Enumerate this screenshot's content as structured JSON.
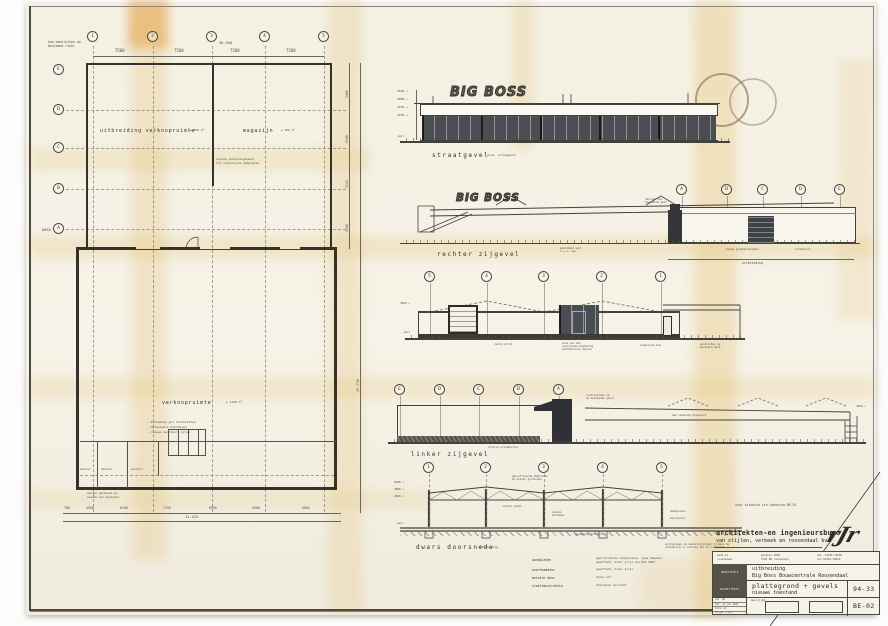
{
  "plan": {
    "cols": [
      "1",
      "2",
      "3",
      "4",
      "5"
    ],
    "rows_letters": [
      "E",
      "D",
      "C",
      "B",
      "A"
    ],
    "dims_top": [
      "7500",
      "7500",
      "7500",
      "7500"
    ],
    "dims_top_total": "30.500",
    "dims_right": [
      "5400",
      "5300",
      "5225",
      "5100"
    ],
    "dims_right_total": "32.720",
    "dim_left": "6850",
    "dims_bottom": [
      "700",
      "4500",
      "6440",
      "7150",
      "6990",
      "5600",
      "6005"
    ],
    "dims_bottom_total": "31.425",
    "label_uitbreiding": "uitbreiding  verkoopruimte",
    "area_uitbreiding": "± 850 m²",
    "label_magazijn": "magazijn",
    "area_magazijn": "± 250 m²",
    "label_verkoop": "verkoopruimte",
    "area_verkoop": "± 1150 m²",
    "note_hwa": [
      "hwa aansluiten op",
      "bestaand riool"
    ],
    "note_wand": [
      "nieuwe scheidingswand",
      "tot onderzijde dakplaten"
    ],
    "notes_links": [
      "- bestaande pui dichtzetten",
      "- metselwerk handhaven",
      "- nieuwe sanitaire groep"
    ],
    "rooms": [
      "kantoor",
      "kantine",
      "sanitair"
    ],
    "note_onder": [
      "wanden aanhelen en",
      "sausen als bestaand"
    ]
  },
  "straatgevel": {
    "label": "straatgevel",
    "sub": "alum. vliesgevel",
    "sign": "BIG BOSS",
    "heights": [
      "5500 +",
      "5000 +",
      "4250 +",
      "3250 +"
    ],
    "peil": "peil"
  },
  "rechter": {
    "label": "rechter  zijgevel",
    "sign": "BIG BOSS",
    "bubbles": [
      "A",
      "B",
      "C",
      "D",
      "E"
    ],
    "dim": "uitbreiding",
    "note_dakrand": [
      "dakrand tpv",
      "bestaande goot"
    ],
    "note_peil": [
      "gemiddeld peil",
      "t.o.v. nap"
    ],
    "note_tegels": "nieuwe grasbetontegels",
    "note_containers": "containers"
  },
  "achter": {
    "bubbles": [
      "5",
      "4",
      "3",
      "2",
      "1"
    ],
    "height": "3600 +",
    "peil": "peil",
    "note_plint": "beton plint",
    "note_pui": [
      "alum pui met",
      "isolerende beglazing",
      "automatische deuren"
    ],
    "note_deur": "aluminium deur",
    "note_rechts": [
      "aansluiten op",
      "bestaand werk"
    ]
  },
  "linker": {
    "label": "linker  zijgevel",
    "bubbles": [
      "E",
      "D",
      "C",
      "B",
      "A"
    ],
    "note_reklame": [
      "lichtreklame op",
      "de bestaande gevel"
    ],
    "note_hwa": "hwa inpandig afgevoerd",
    "note_grond": "interne grondkering",
    "height": "4300 +"
  },
  "doorsnede": {
    "label": "dwars  doorsnede",
    "sub": "uitbreiding",
    "bubbles": [
      "1",
      "2",
      "3",
      "4",
      "5"
    ],
    "heights": [
      "5300 +",
      "4800 +",
      "4300 +"
    ],
    "peil": "peil",
    "note_dak": [
      "geprofileerde dakplaten",
      "op stalen gordingen"
    ],
    "note_spant": "stalen spant",
    "note_kolom": [
      "stalen",
      "kolommen"
    ],
    "note_vloer": "gewapende betonvloer",
    "note_rechts": [
      "wandplaten",
      "betonplint"
    ]
  },
  "legend": {
    "rows": [
      {
        "term": "wandplaten",
        "desc1": "geprofileerde staalplaten, type damwand",
        "desc2": "gemoffeld, kleur grijs als RAL 9002"
      },
      {
        "term": "overheaddeur",
        "desc1": "gemoffeld, kleur grijs",
        "desc2": ""
      },
      {
        "term": "metalen deur",
        "desc1": "kleur wit",
        "desc2": ""
      },
      {
        "term": "staalkonstruktie",
        "desc1": "thermisch verzinkt",
        "desc2": ""
      }
    ]
  },
  "note_situatie": "voor situatie zie tekening BE-01",
  "note_wijzigingen": [
    "wijzigingen en maatafwijkingen tijdens de",
    "uitvoering in overleg met de architekt"
  ],
  "titleblock": {
    "firm1": "architekten-en ingenieursburo",
    "firm2": "van stijlen, verbeek en roosendaal bv",
    "logo": "rJr",
    "addr1a": "kade 41",
    "addr1b": "roosendaal",
    "addr2a": "postbus 1068",
    "addr2b": "4700 BB roosendaal",
    "tel": "tel. 01650-35600",
    "fax": "fax 01650-58620",
    "row1_label": "opdracht",
    "project1": "uitbreiding",
    "project2": "Big Boss  Bouwcentrale   Roosendaal",
    "row2_label": "onderdeel",
    "part1": "plattegrond + gevels",
    "part2": "nieuwe  toestand",
    "number": "94-33",
    "micro": [
      "get. RK",
      "dat. 14 jan 1994",
      "form. A1",
      "schaal 1:100"
    ],
    "gewijzigd": "gewijzigd",
    "sheet": "BE-02"
  }
}
